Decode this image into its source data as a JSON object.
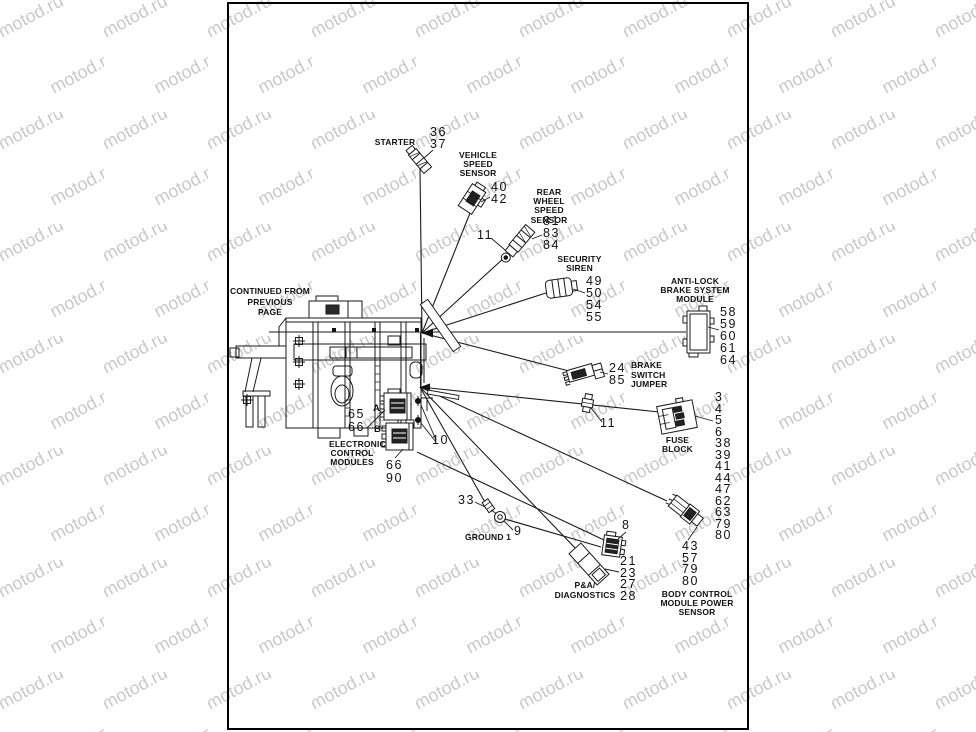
{
  "watermark": {
    "text": "motod.ru",
    "color": "#c9c9c9"
  },
  "notes": {
    "continued": "CONTINUED FROM\nPREVIOUS\nPAGE"
  },
  "callouts": {
    "starter": {
      "label": "STARTER",
      "nums": "36\n37"
    },
    "vss": {
      "label": "VEHICLE\nSPEED\nSENSOR",
      "nums": "40\n42"
    },
    "rear_wheel": {
      "label": "REAR WHEEL\nSPEED\nSENSOR",
      "nums": "81\n83\n84",
      "ref": "11"
    },
    "siren": {
      "label": "SECURITY\nSIREN",
      "nums": "49\n50\n54\n55"
    },
    "abs": {
      "label": "ANTI-LOCK\nBRAKE SYSTEM\nMODULE",
      "nums": "58\n59\n60\n61\n64"
    },
    "brake_jumper": {
      "label": "BRAKE\nSWITCH\nJUMPER",
      "nums": "24\n85",
      "ref": "11"
    },
    "fuse_block": {
      "label": "FUSE\nBLOCK",
      "nums": "3\n4\n5\n6\n38\n39\n41\n44\n47\n62\n63\n79\n80"
    },
    "bcm": {
      "label": "BODY CONTROL\nMODULE POWER\nSENSOR",
      "nums": "43\n57\n79\n80"
    },
    "pa_diag": {
      "label": "P&A/\nDIAGNOSTICS",
      "nums": "21\n23\n27\n28",
      "ref": "8"
    },
    "ground": {
      "label": "GROUND 1",
      "ref_clip": "33",
      "ref_ring": "9"
    },
    "ecm": {
      "label": "ELECTRONIC\nCONTROL\nMODULES",
      "nums_a": "65\n66",
      "nums_b": "66\n90",
      "tag_a": "A",
      "tag_b": "B",
      "ref_bolts": "10"
    }
  }
}
